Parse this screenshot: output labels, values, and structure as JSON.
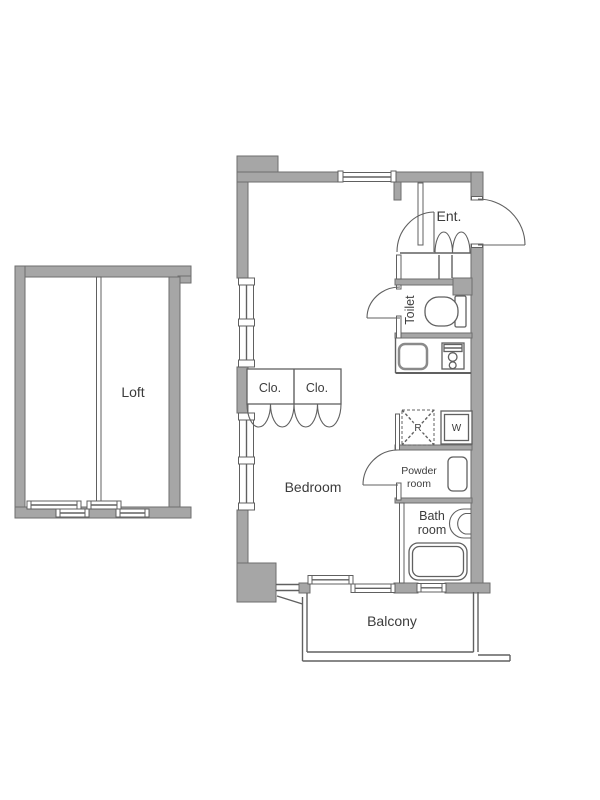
{
  "colors": {
    "wall_fill": "#a6a6a6",
    "wall_stroke": "#6e6e6e",
    "line": "#606060",
    "text": "#3c3c3c",
    "bg": "#ffffff"
  },
  "labels": {
    "loft": "Loft",
    "bedroom": "Bedroom",
    "balcony": "Balcony",
    "entrance": "Ent.",
    "toilet": "Toilet",
    "closet_left": "Clo.",
    "closet_right": "Clo.",
    "powder_line1": "Powder",
    "powder_line2": "room",
    "bath_line1": "Bath",
    "bath_line2": "room",
    "refrigerator": "R",
    "washer": "W"
  }
}
